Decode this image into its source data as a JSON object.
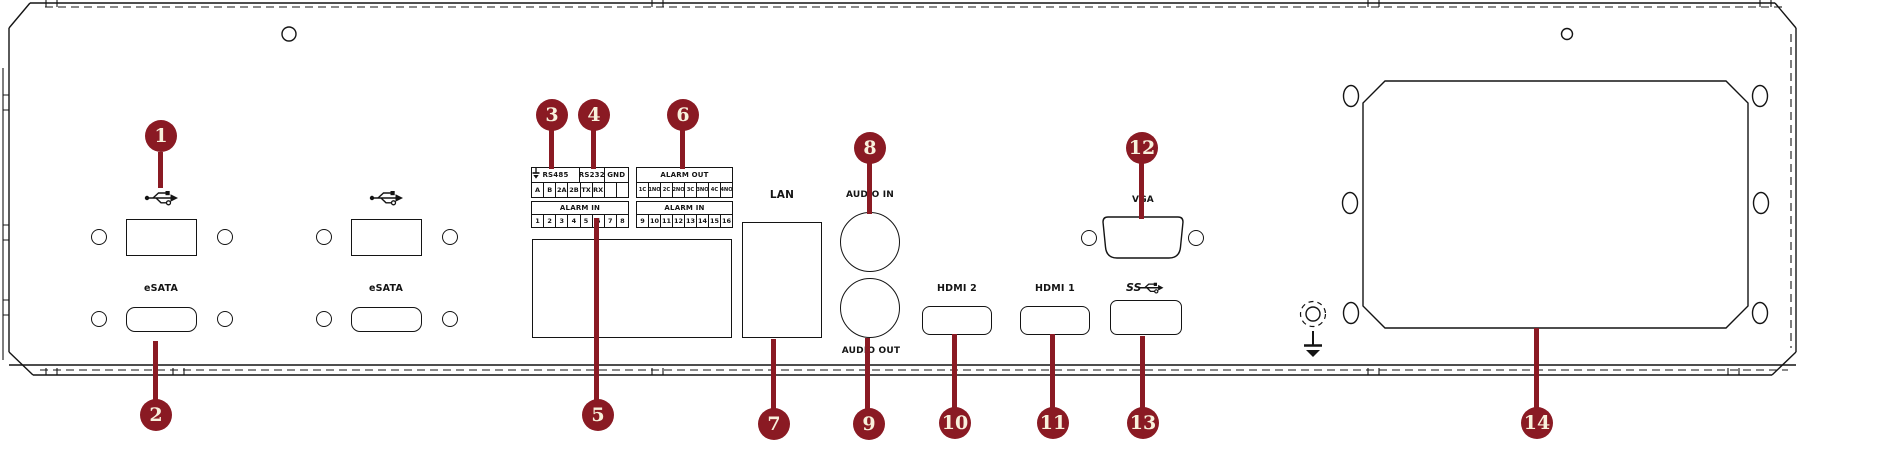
{
  "figure": {
    "title": "NVR rear panel interface diagram",
    "colors": {
      "callout": "#8a1a23",
      "callout_text": "#f8f1dc",
      "line": "#141414"
    }
  },
  "labels": {
    "esata1": "eSATA",
    "esata2": "eSATA",
    "lan": "LAN",
    "audio_in": "AUDIO IN",
    "audio_out": "AUDIO OUT",
    "hdmi2": "HDMI 2",
    "hdmi1": "HDMI 1",
    "vga": "VGA",
    "usb3_ss": "SS"
  },
  "icons": [
    "usb-icon",
    "usb-icon",
    "usb3-ss-icon",
    "ground-icon",
    "protective-earth-icon",
    "earth-terminal-icon"
  ],
  "terminal_blocks": [
    {
      "name": "serial-terminal-block",
      "x": 532,
      "y": 168,
      "w": 97,
      "rows": [
        {
          "h": 15,
          "header": true,
          "cells": [
            {
              "t": "RS485",
              "span": 4
            },
            {
              "t": "RS232",
              "span": 2
            },
            {
              "t": "GND",
              "span": 2
            }
          ]
        },
        {
          "h": 15,
          "cells": [
            {
              "t": "A"
            },
            {
              "t": "B"
            },
            {
              "t": "2A"
            },
            {
              "t": "2B"
            },
            {
              "t": "TX"
            },
            {
              "t": "RX"
            },
            {
              "icon": "ground"
            },
            {
              "icon": "ground"
            }
          ]
        }
      ]
    },
    {
      "name": "alarm-out-terminal-block",
      "x": 637,
      "y": 168,
      "w": 96,
      "rows": [
        {
          "h": 15,
          "header": true,
          "cells": [
            {
              "t": "ALARM OUT",
              "span": 8
            }
          ]
        },
        {
          "h": 15,
          "cells": [
            {
              "t": "1C",
              "small": true
            },
            {
              "t": "1NO",
              "small": true
            },
            {
              "t": "2C",
              "small": true
            },
            {
              "t": "2NO",
              "small": true
            },
            {
              "t": "3C",
              "small": true
            },
            {
              "t": "3NO",
              "small": true
            },
            {
              "t": "4C",
              "small": true
            },
            {
              "t": "4NO",
              "small": true
            }
          ]
        }
      ]
    },
    {
      "name": "alarm-in-terminal-block-1",
      "x": 532,
      "y": 202,
      "w": 97,
      "rows": [
        {
          "h": 13,
          "header": true,
          "cells": [
            {
              "t": "ALARM IN",
              "span": 8
            }
          ]
        },
        {
          "h": 13,
          "cells": [
            {
              "t": "1"
            },
            {
              "t": "2"
            },
            {
              "t": "3"
            },
            {
              "t": "4"
            },
            {
              "t": "5"
            },
            {
              "t": "6"
            },
            {
              "t": "7"
            },
            {
              "t": "8"
            }
          ]
        }
      ]
    },
    {
      "name": "alarm-in-terminal-block-2",
      "x": 637,
      "y": 202,
      "w": 96,
      "rows": [
        {
          "h": 13,
          "header": true,
          "cells": [
            {
              "t": "ALARM IN",
              "span": 8
            }
          ]
        },
        {
          "h": 13,
          "cells": [
            {
              "t": "9"
            },
            {
              "t": "10"
            },
            {
              "t": "11"
            },
            {
              "t": "12"
            },
            {
              "t": "13"
            },
            {
              "t": "14"
            },
            {
              "t": "15"
            },
            {
              "t": "16"
            }
          ]
        }
      ]
    }
  ],
  "callouts": [
    {
      "n": "1",
      "cx": 161,
      "cy": 136,
      "sx": 160.5,
      "sy1": 152,
      "sy2": 188
    },
    {
      "n": "2",
      "cx": 156,
      "cy": 415,
      "sx": 155,
      "sy1": 341,
      "sy2": 400
    },
    {
      "n": "3",
      "cx": 552,
      "cy": 115,
      "sx": 551,
      "sy1": 130,
      "sy2": 169
    },
    {
      "n": "4",
      "cx": 594,
      "cy": 115,
      "sx": 593,
      "sy1": 130,
      "sy2": 169
    },
    {
      "n": "5",
      "cx": 598,
      "cy": 415,
      "sx": 596,
      "sy1": 218,
      "sy2": 400
    },
    {
      "n": "6",
      "cx": 683,
      "cy": 115,
      "sx": 682,
      "sy1": 130,
      "sy2": 169
    },
    {
      "n": "7",
      "cx": 774,
      "cy": 424,
      "sx": 773,
      "sy1": 339,
      "sy2": 409
    },
    {
      "n": "8",
      "cx": 870,
      "cy": 148,
      "sx": 869,
      "sy1": 163,
      "sy2": 214
    },
    {
      "n": "9",
      "cx": 869,
      "cy": 424,
      "sx": 867.5,
      "sy1": 338,
      "sy2": 409
    },
    {
      "n": "10",
      "cx": 955,
      "cy": 423,
      "sx": 954.5,
      "sy1": 334,
      "sy2": 408
    },
    {
      "n": "11",
      "cx": 1053,
      "cy": 423,
      "sx": 1052.5,
      "sy1": 334,
      "sy2": 408
    },
    {
      "n": "12",
      "cx": 1142,
      "cy": 148,
      "sx": 1141.5,
      "sy1": 163,
      "sy2": 219
    },
    {
      "n": "13",
      "cx": 1143,
      "cy": 423,
      "sx": 1142.5,
      "sy1": 336,
      "sy2": 408
    },
    {
      "n": "14",
      "cx": 1537,
      "cy": 423,
      "sx": 1536.5,
      "sy1": 328,
      "sy2": 408
    }
  ]
}
